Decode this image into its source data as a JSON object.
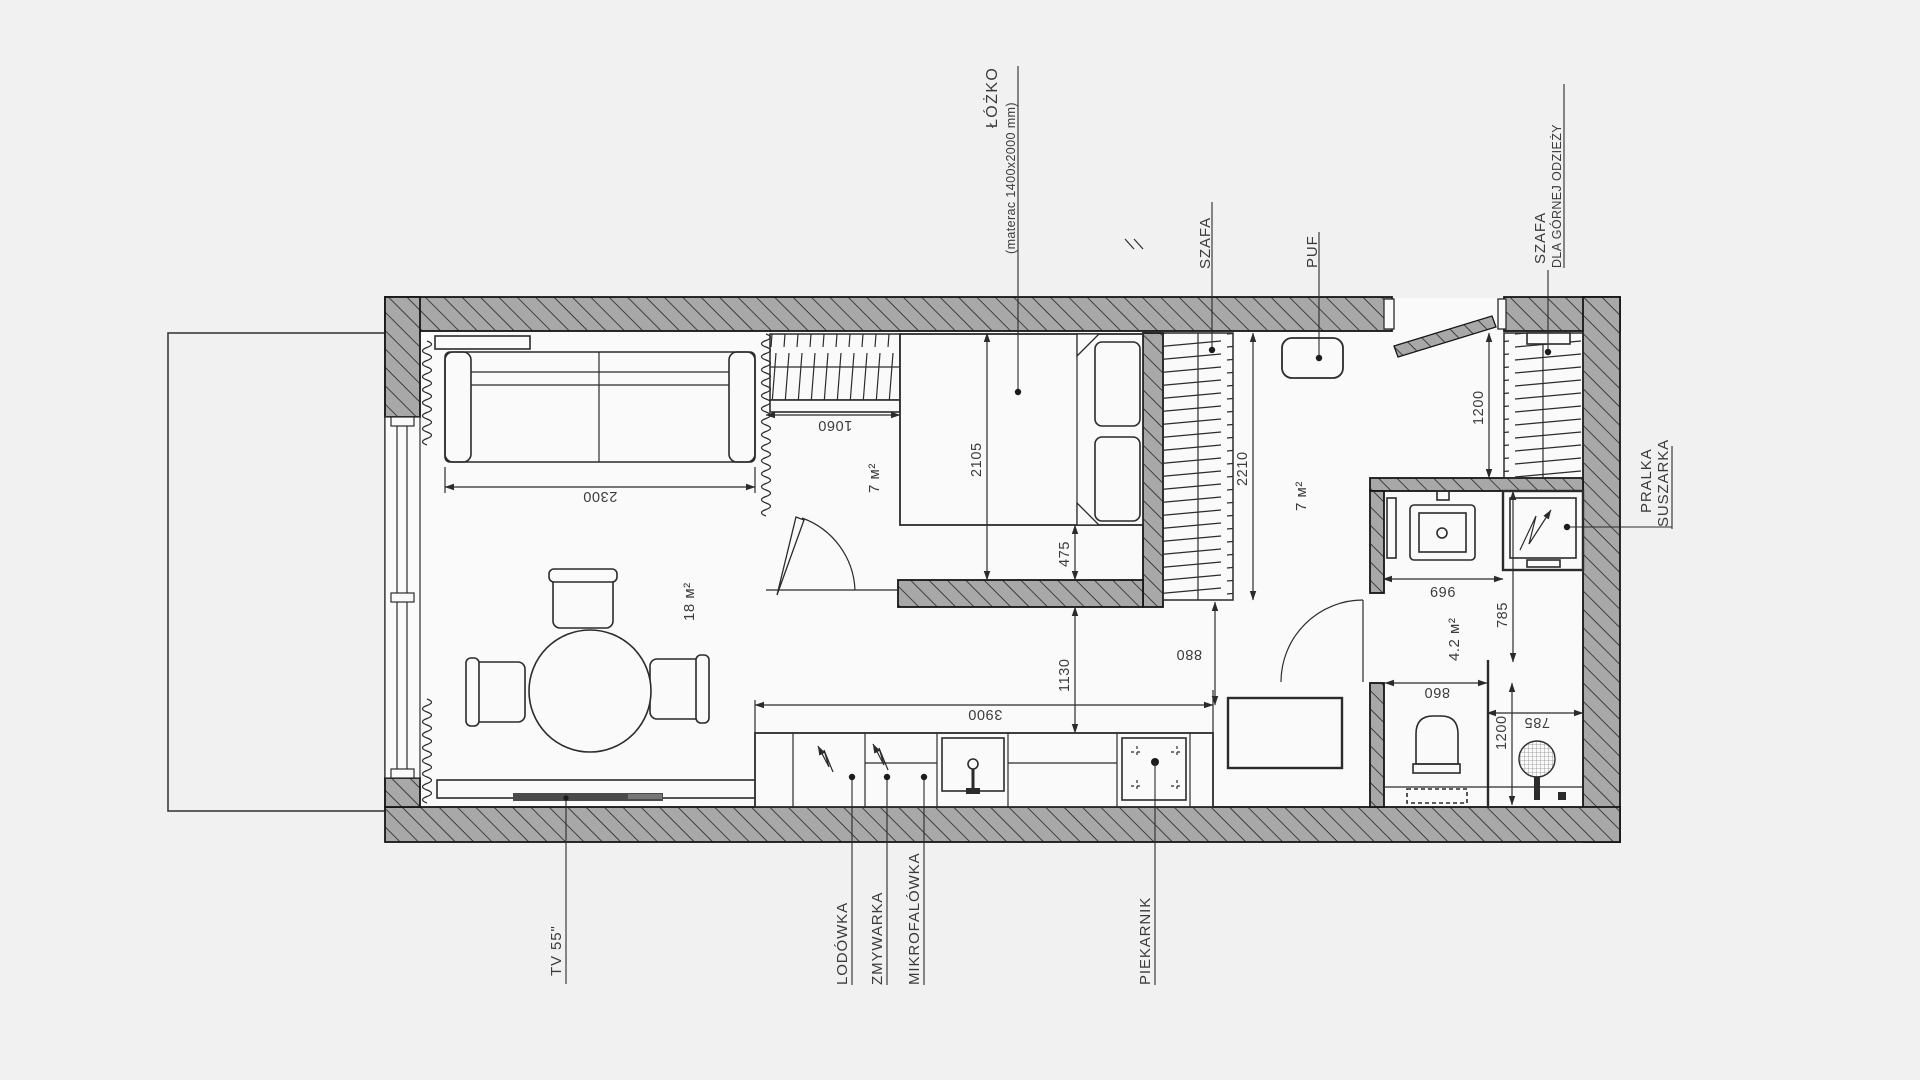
{
  "title": "Rzut mieszkania - studio",
  "labels": {
    "bed": "ŁÓŻKO",
    "bed_sub": "(materac 1400x2000 mm)",
    "wardrobe": "SZAFA",
    "puf": "PUF",
    "coat_closet_1": "SZAFA",
    "coat_closet_2": "DLA GÓRNEJ ODZIEŻY",
    "washer_1": "PRALKA",
    "washer_2": "SUSZARKA",
    "tv": "TV 55\"",
    "fridge": "LODÓWKA",
    "dishwasher": "ZMYWARKA",
    "microwave": "MIKROFALÓWKA",
    "oven": "PIEKARNIK"
  },
  "areas": {
    "living": "18 м²",
    "bedroom": "7 м²",
    "hallway": "7 м²",
    "bathroom": "4.2 м²"
  },
  "dimensions": {
    "sofa_width": "2300",
    "bed_wardrobe_width": "1060",
    "bed_length": "2105",
    "bed_to_wall": "475",
    "bedroom_to_kitchen": "1130",
    "kitchen_run": "3900",
    "hall_wardrobe_depth": "2210",
    "wardrobe_to_counter": "880",
    "coat_closet_width": "1200",
    "bath_wall": "696",
    "bath_depth": "785",
    "toilet_zone": "860",
    "shower_depth": "1200",
    "shower_width": "785"
  },
  "colors": {
    "wall_fill": "#a8a8a8",
    "line": "#2b2b2b",
    "floor": "#fafafa",
    "background": "#f1f1f2"
  }
}
